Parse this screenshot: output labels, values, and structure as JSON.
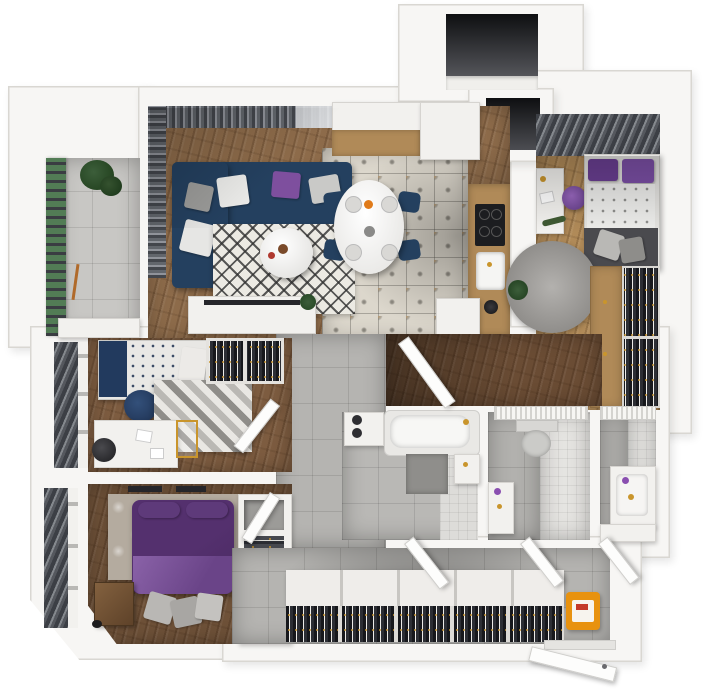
{
  "scene": {
    "type": "3d-floor-plan-render",
    "view": "top-down axonometric apartment render",
    "background": "#ffffff",
    "title": "Apartment 3D floor plan"
  },
  "colors": {
    "wall": "#f7f6f4",
    "wall_edge": "#d9d7d2",
    "wood_living": "#8d6b4a",
    "wood_light": "#b08a58",
    "wood_dark": "#6a4c34",
    "wood_kids": "#7d5c40",
    "wood_master": "#6e5138",
    "tile_gray": "#b5b4b1",
    "tile_light": "#e6e5e2",
    "tile_ornate": "#dcd7cc",
    "sofa_navy": "#24405f",
    "accent_purple": "#7e4f9e",
    "bed_purple": "#54306e",
    "bed_purple_light": "#8a62a8",
    "gold": "#c9952c",
    "slat_dark": "#23242a",
    "curtain": "#4b4e54",
    "green": "#527c55",
    "shaft": "#141518",
    "rug_light": "#eceae3",
    "gray_rug": "#a3a19e",
    "orange": "#e8920f"
  },
  "rooms": [
    {
      "id": "living-room",
      "name": "Living room",
      "floor": "wood"
    },
    {
      "id": "kitchen-dining",
      "name": "Kitchen and dining area",
      "floor": "ornate tile"
    },
    {
      "id": "bedroom",
      "name": "Bedroom",
      "floor": "light wood"
    },
    {
      "id": "kids-room",
      "name": "Kids room / office",
      "floor": "wood"
    },
    {
      "id": "master-bedroom",
      "name": "Master bedroom",
      "floor": "wood"
    },
    {
      "id": "bathroom",
      "name": "Bathroom",
      "floor": "gray tile"
    },
    {
      "id": "wc",
      "name": "Toilet",
      "floor": "gray and white tile"
    },
    {
      "id": "bathroom-2",
      "name": "Shower room",
      "floor": "gray and white tile"
    },
    {
      "id": "hallway",
      "name": "Entrance hallway",
      "floor": "gray tile"
    },
    {
      "id": "corridor",
      "name": "Corridor",
      "floor": "dark wood and gray tile"
    },
    {
      "id": "balcony",
      "name": "Balcony",
      "floor": "gray tile"
    },
    {
      "id": "shafts",
      "name": "Ventilation shafts",
      "floor": "none"
    }
  ],
  "furniture": {
    "living_room": [
      "navy corner sofa",
      "gray white and purple cushions",
      "round coffee table",
      "diamond pattern rug",
      "TV sideboard",
      "curtains",
      "plant"
    ],
    "kitchen_dining": [
      "oval dining table",
      "four navy chairs",
      "table setting",
      "kitchen cabinets",
      "wood counter",
      "induction hob",
      "kitchen sink"
    ],
    "bedroom": [
      "single bed with purple pillows",
      "dark footbench with gray cushions",
      "desk",
      "purple chair",
      "round fluffy rug",
      "wardrobe with clothes rail",
      "window blinds"
    ],
    "kids_room": [
      "bed with navy bedding",
      "navy pouf",
      "zigzag rug",
      "white desk",
      "desk chair",
      "open wardrobe with clothes",
      "window blinds"
    ],
    "master_bedroom": [
      "double bed with purple bedding",
      "mottled rug",
      "leather chest",
      "gray floor cushions",
      "shelving wardrobe",
      "wall TV"
    ],
    "bathroom": [
      "bathtub",
      "washing machine",
      "washbasin with gold tap",
      "shower mat"
    ],
    "wc": [
      "toilet",
      "small washbasin",
      "radiator"
    ],
    "bathroom_2": [
      "washbasin cabinet with gold tap",
      "bench",
      "radiator"
    ],
    "hallway": [
      "long built-in wardrobe",
      "clothes rail",
      "orange storage box",
      "entrance door"
    ],
    "balcony": [
      "louvered railing",
      "potted plant",
      "bench ledge"
    ]
  }
}
